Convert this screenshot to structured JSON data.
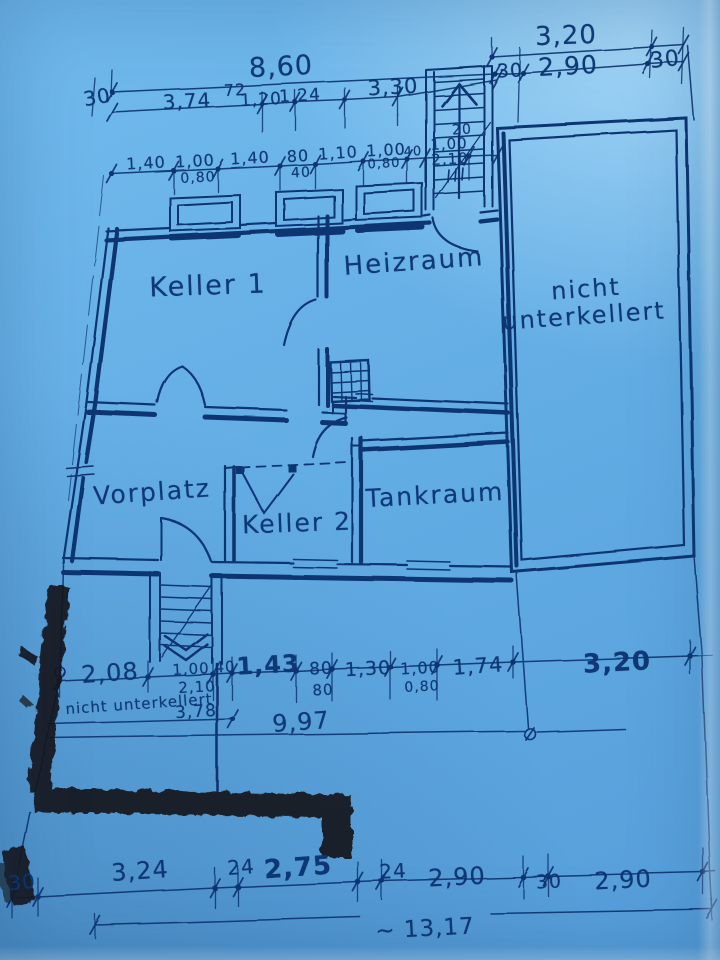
{
  "document": {
    "type": "basement floor plan blueprint photo",
    "paper_color": "#69b3e9",
    "ink_color": "#0d3572",
    "pencil_color": "#15171c"
  },
  "rooms": {
    "keller1": "Keller 1",
    "heizraum": "Heizraum",
    "nicht1": "nicht",
    "nicht2": "unterkellert",
    "vorplatz": "Vorplatz",
    "keller2": "Keller 2",
    "tankraum": "Tankraum",
    "annex": "nicht unterkellert"
  },
  "dims": [
    "3,20",
    "30",
    "8,60",
    "30",
    "2,90",
    "30",
    "3,74",
    "72",
    "1,20",
    "1,24",
    "3,30",
    "20",
    "1,40",
    "1,00",
    "0,80",
    "1,40",
    "80",
    "40",
    "1,10",
    "1,00",
    "0,80",
    "40",
    "1,00",
    "2,10",
    "2,08",
    "1,00",
    "2,10",
    "40",
    "1,43",
    "80",
    "80",
    "1,30",
    "1,00",
    "0,80",
    "1,74",
    "3,20",
    "3,78",
    "9,97",
    "30",
    "3,24",
    "24",
    "2,75",
    "24",
    "2,90",
    "30",
    "2,90",
    "~ 13,17"
  ]
}
